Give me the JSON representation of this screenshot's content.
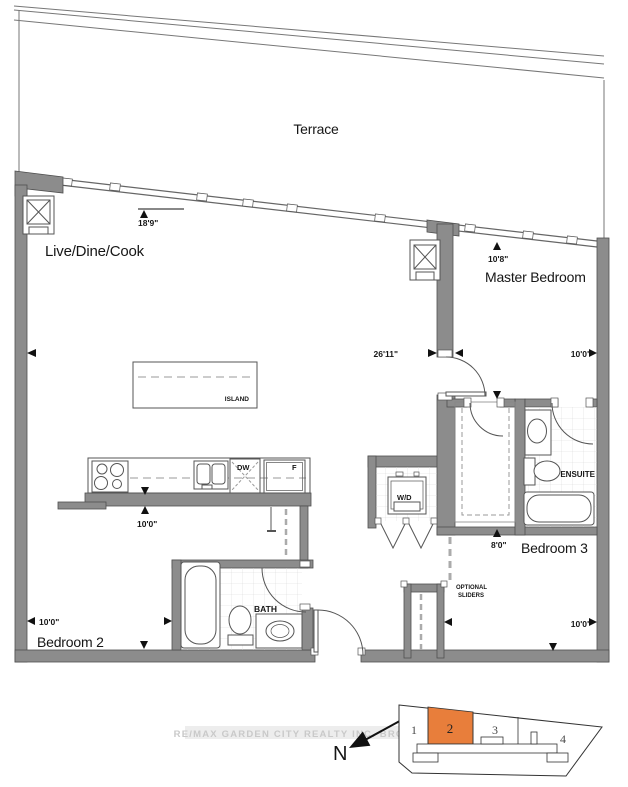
{
  "plan": {
    "rooms": {
      "terrace": "Terrace",
      "live_dine_cook": "Live/Dine/Cook",
      "master_bedroom": "Master Bedroom",
      "bedroom_2": "Bedroom 2",
      "bedroom_3": "Bedroom 3",
      "bath": "BATH",
      "ensuite": "ENSUITE"
    },
    "fixtures": {
      "island": "ISLAND",
      "washer_dryer": "W/D",
      "dishwasher": "DW",
      "fridge": "F",
      "optional_sliders_line1": "OPTIONAL",
      "optional_sliders_line2": "SLIDERS"
    },
    "dimensions": {
      "living_depth": "18'9\"",
      "master_depth": "10'8\"",
      "living_width": "26'11\"",
      "master_width": "10'0\"",
      "bedroom_2_depth": "10'0\"",
      "bedroom_2_width": "10'0\"",
      "bedroom_3_depth": "8'0\"",
      "bedroom_3_width": "10'0\""
    },
    "compass_label": "N",
    "watermark": "RE/MAX GARDEN CITY REALTY INC. BROKERAGE",
    "keyplan": {
      "units": [
        "1",
        "2",
        "3",
        "4"
      ],
      "highlighted_unit": "2",
      "highlight_color": "#E87E3B"
    },
    "colors": {
      "wall_fill": "#8C8C8C",
      "line": "#555555",
      "highlight": "#E87E3B",
      "watermark": "#C9C9C9"
    }
  }
}
